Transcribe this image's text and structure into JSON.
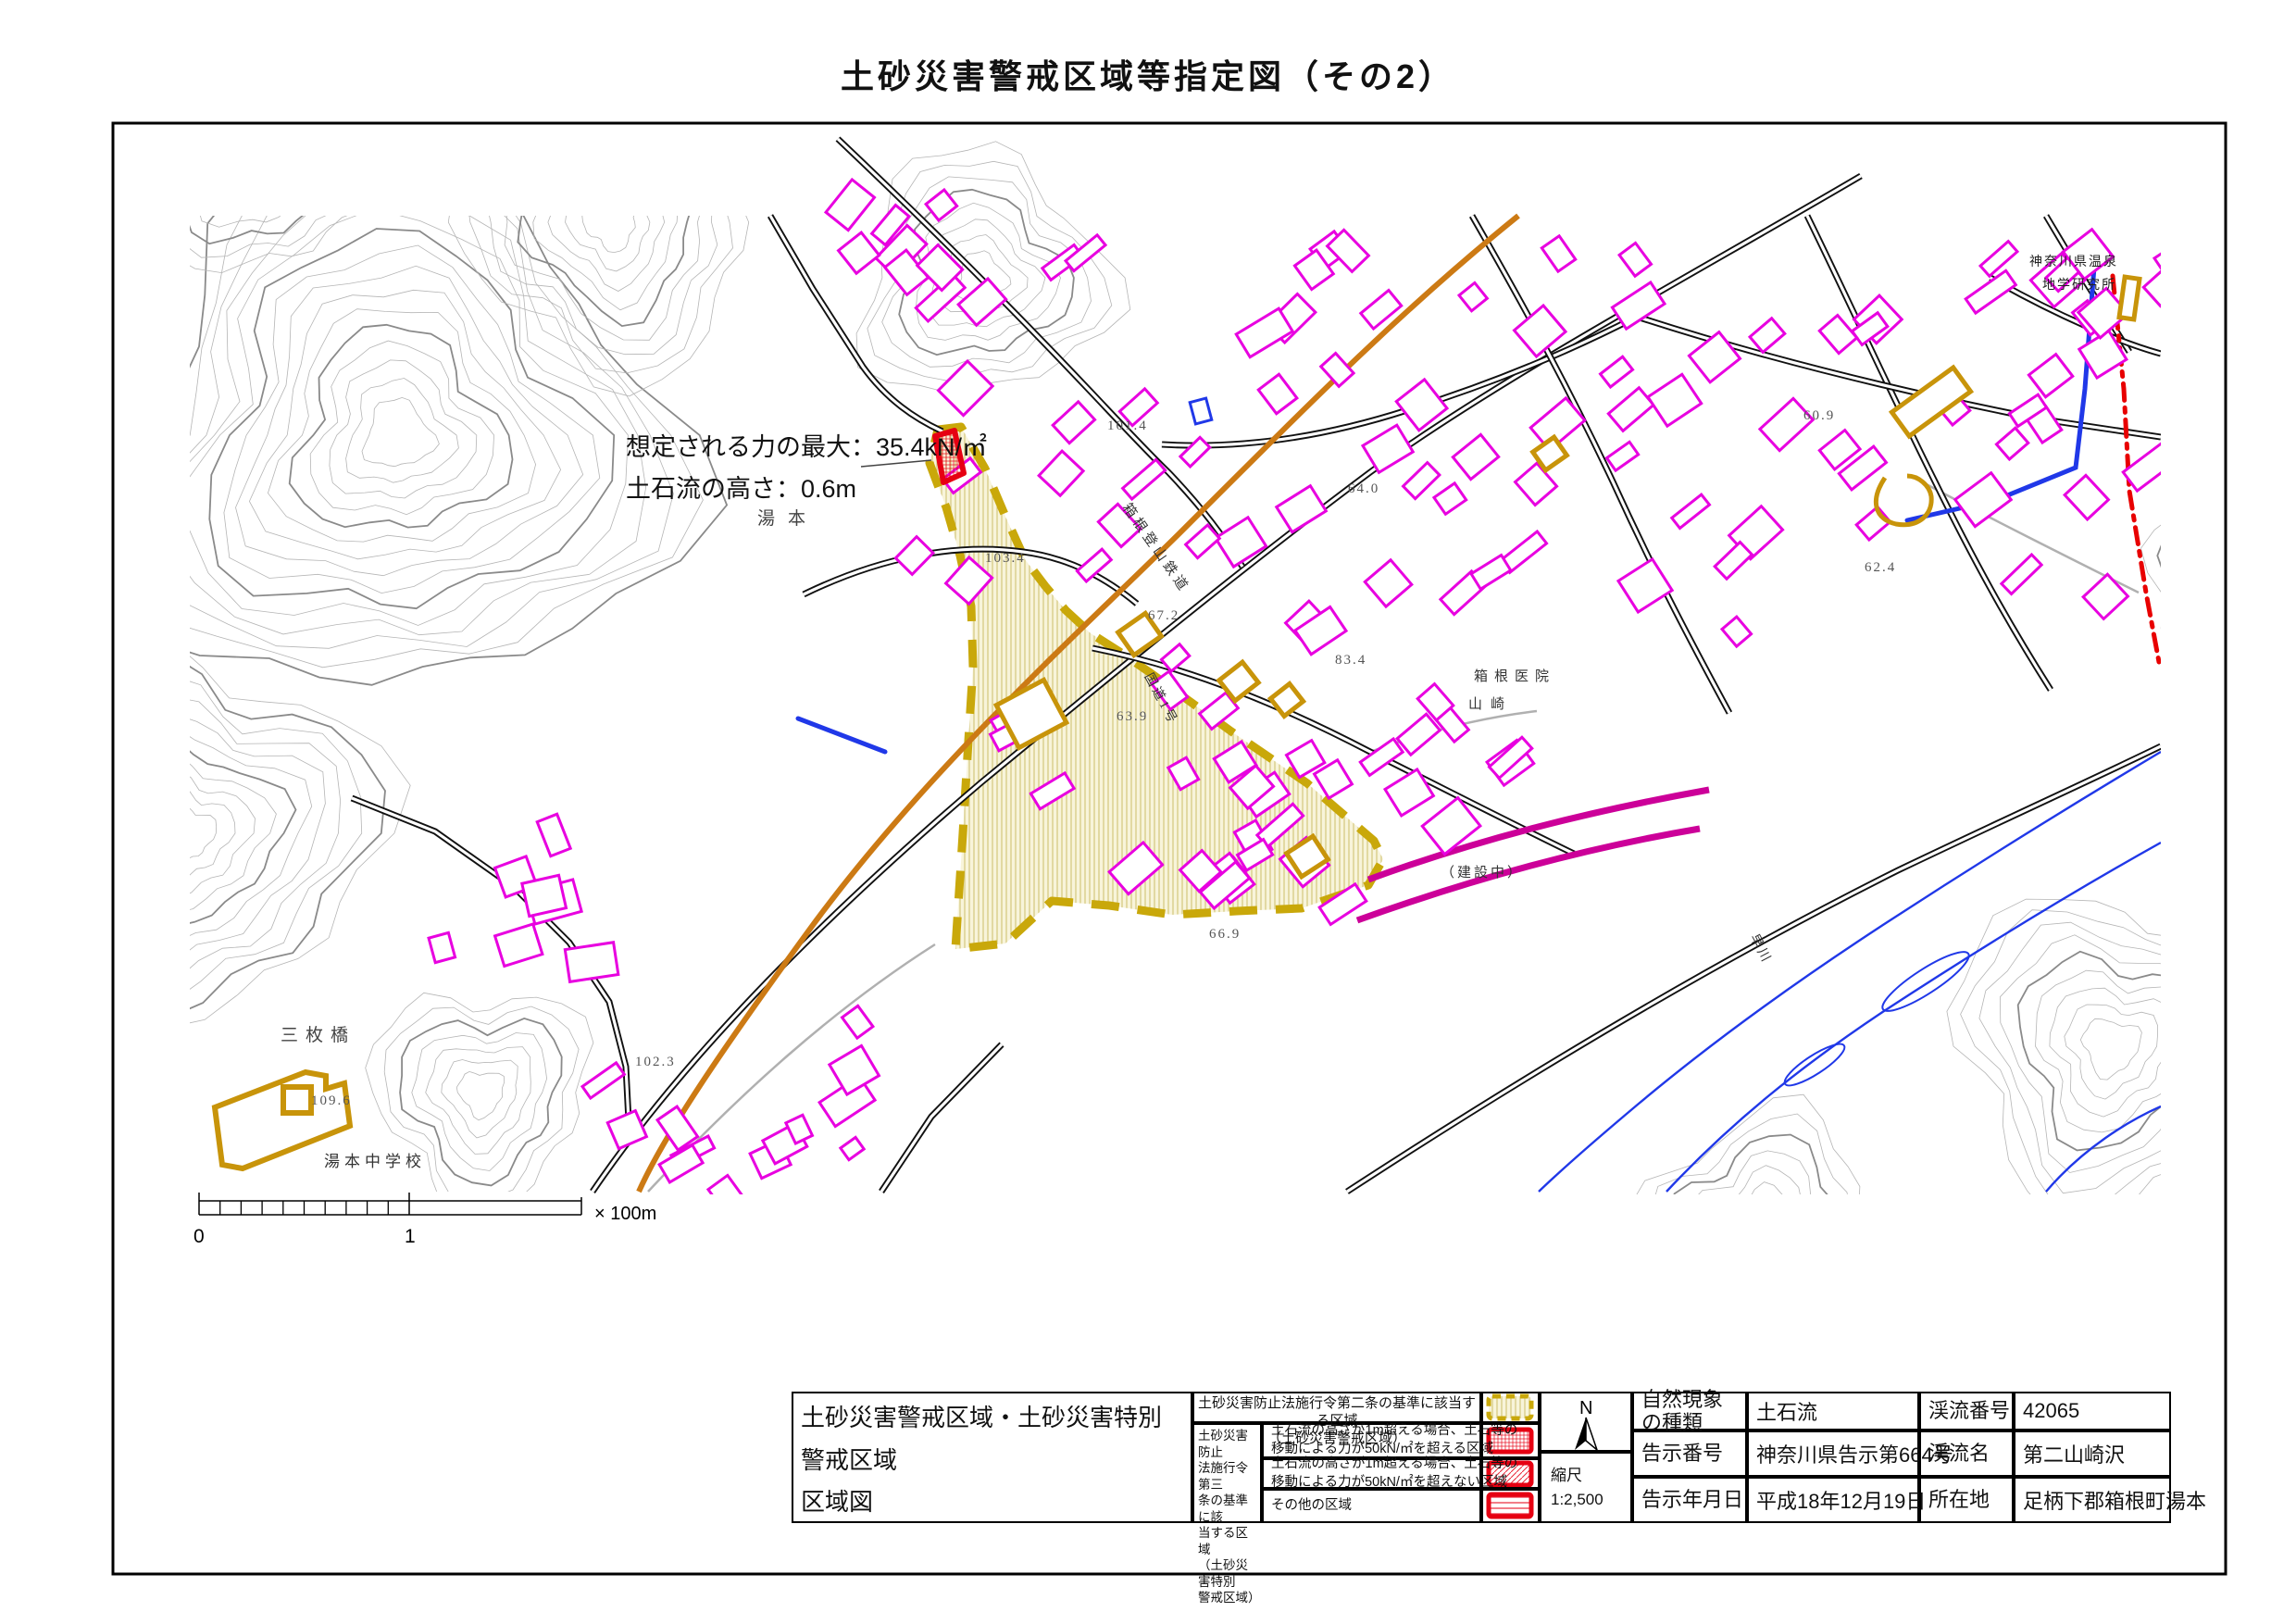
{
  "title": "土砂災害警戒区域等指定図（その2）",
  "map": {
    "annotation_line1": "想定される力の最大：35.4kN/㎡",
    "annotation_line2": "土石流の高さ：0.6m",
    "place_labels": [
      {
        "text": "湯本"
      },
      {
        "text": "三枚橋"
      },
      {
        "text": "湯本中学校"
      },
      {
        "text": "箱根医院"
      },
      {
        "text": "山崎"
      },
      {
        "text": "（建設中）"
      },
      {
        "text": "神奈川県温泉"
      },
      {
        "text": "地学研究所"
      },
      {
        "text": "早川"
      },
      {
        "text": "箱根登山鉄道"
      },
      {
        "text": "国道1号"
      }
    ],
    "elevation_labels": [
      {
        "text": "101.4"
      },
      {
        "text": "103.4"
      },
      {
        "text": "102.3"
      },
      {
        "text": "109.6"
      },
      {
        "text": "67.2"
      },
      {
        "text": "63.9"
      },
      {
        "text": "64.0"
      },
      {
        "text": "66.9"
      },
      {
        "text": "60.9"
      },
      {
        "text": "62.4"
      },
      {
        "text": "83.4"
      }
    ],
    "scale_bar": {
      "zero": "0",
      "one": "1",
      "unit": "× 100m"
    }
  },
  "legend": {
    "doc_title_line1": "土砂災害警戒区域・土砂災害特別警戒区域",
    "doc_title_line2": "区域図",
    "row1_line1": "土砂災害防止法施行令第二条の基準に該当する区域",
    "row1_line2": "（土砂災害警戒区域）",
    "special_label": "土砂災害防止\n法施行令第三\n条の基準に該\n当する区域\n（土砂災害特別\n警戒区域）",
    "row2_line1": "土石流の高さが1m超える場合、土石等の",
    "row2_line2": "移動による力が50kN/㎡を超える区域",
    "row3_line1": "土石流の高さが1m超える場合、土石等の",
    "row3_line2": "移動による力が50kN/㎡を超えない区域",
    "row4": "その他の区域",
    "north": "N",
    "scale_label": "縮尺",
    "scale_value": "1:2,500"
  },
  "info": {
    "rows": [
      {
        "c0": "自然現象\nの種類",
        "c1": "土石流",
        "c2": "渓流番号",
        "c3": "42065"
      },
      {
        "c0": "告示番号",
        "c1": "神奈川県告示第664号",
        "c2": "渓流名",
        "c3": "第二山崎沢"
      },
      {
        "c0": "告示年月日",
        "c1": "平成18年12月19日",
        "c2": "所在地",
        "c3": "足柄下郡箱根町湯本"
      }
    ]
  },
  "colors": {
    "warning_zone": "#c9a80a",
    "special_zone": "#e60012",
    "building_outline": "#e800e0",
    "public_building": "#c8940a",
    "water": "#2038e8",
    "road_orange": "#cc7a14",
    "railway": "#cc0099",
    "admin_boundary": "#e80000"
  }
}
